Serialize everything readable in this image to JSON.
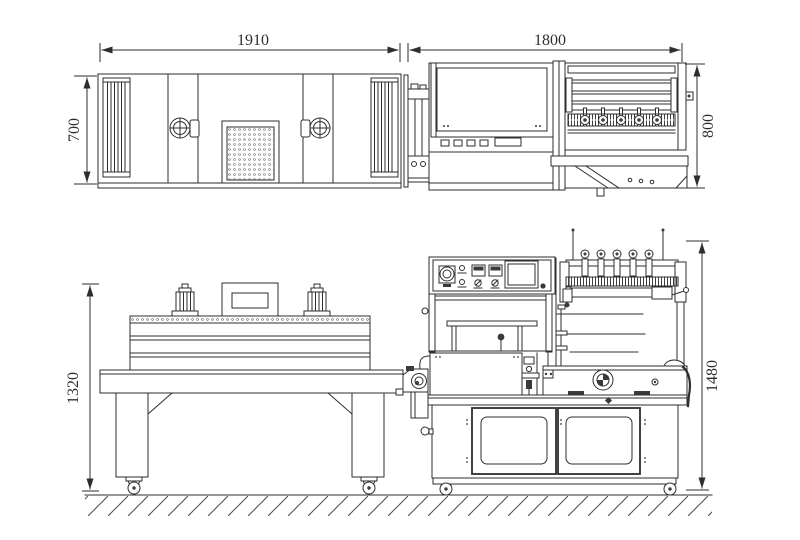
{
  "drawing": {
    "background": "#ffffff",
    "line_color": "#2e2e2e",
    "dimensions": {
      "tunnel_top_width": "1910",
      "sealer_top_width": "1800",
      "tunnel_top_depth": "700",
      "sealer_top_depth": "800",
      "tunnel_side_height": "1320",
      "sealer_side_height": "1480"
    }
  }
}
